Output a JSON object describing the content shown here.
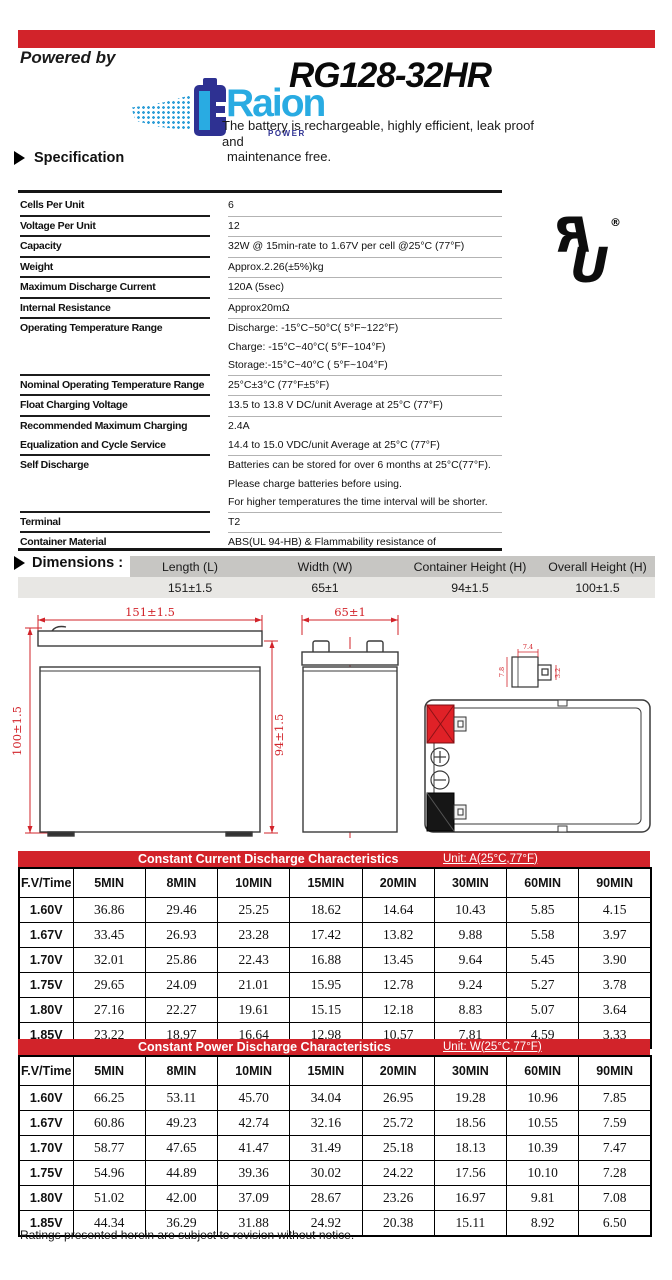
{
  "colors": {
    "accent_red": "#d2232a",
    "logo_blue": "#29abe2",
    "logo_dark_blue": "#2e3192",
    "dim_header_grey": "#c7c6c3",
    "dim_value_grey": "#e8e7e4"
  },
  "header": {
    "powered_by": "Powered by",
    "brand": "Raion",
    "brand_sub": "POWER",
    "model": "RG128-32HR",
    "description_line1": "The battery is rechargeable, highly efficient, leak proof and",
    "description_line2": "maintenance free.",
    "section_specification": "Specification"
  },
  "spec": {
    "rows": [
      {
        "label": [
          "Cells Per Unit"
        ],
        "value": [
          "6"
        ]
      },
      {
        "label": [
          "Voltage Per Unit"
        ],
        "value": [
          "12"
        ]
      },
      {
        "label": [
          "Capacity"
        ],
        "value": [
          "32W @ 15min-rate to 1.67V per cell @25°C (77°F)"
        ]
      },
      {
        "label": [
          "Weight"
        ],
        "value": [
          "Approx.2.26(±5%)kg"
        ]
      },
      {
        "label": [
          "Maximum Discharge Current"
        ],
        "value": [
          "120A (5sec)"
        ]
      },
      {
        "label": [
          "Internal Resistance"
        ],
        "value": [
          "Approx20mΩ"
        ]
      },
      {
        "label": [
          "Operating Temperature Range"
        ],
        "value": [
          "Discharge: -15°C~50°C( 5°F~122°F)",
          "Charge: -15°C~40°C( 5°F~104°F)",
          "Storage:-15°C~40°C ( 5°F~104°F)"
        ]
      },
      {
        "label": [
          "Nominal Operating Temperature Range"
        ],
        "value": [
          "25°C±3°C (77°F±5°F)"
        ]
      },
      {
        "label": [
          "Float Charging Voltage"
        ],
        "value": [
          "13.5 to 13.8 V DC/unit Average at 25°C (77°F)"
        ]
      },
      {
        "label": [
          "Recommended Maximum Charging",
          "Equalization and Cycle Service"
        ],
        "value": [
          "2.4A",
          "14.4 to 15.0 VDC/unit Average at 25°C (77°F)"
        ]
      },
      {
        "label": [
          "Self Discharge"
        ],
        "value": [
          "Batteries can be stored for over 6 months at 25°C(77°F).",
          "Please charge batteries before using.",
          "For higher temperatures the time interval will be shorter."
        ]
      },
      {
        "label": [
          "Terminal"
        ],
        "value": [
          "T2"
        ]
      },
      {
        "label": [
          "Container Material"
        ],
        "value": [
          "ABS(UL 94-HB) & Flammability resistance of",
          "(UL 94-V0) can be available upon request."
        ]
      }
    ]
  },
  "ul_mark": {
    "registered": "®"
  },
  "dimensions": {
    "title": "Dimensions :",
    "unit": "Unit: mm",
    "columns": [
      "Length (L)",
      "Width (W)",
      "Container Height (H)",
      "Overall Height (H)"
    ],
    "values": [
      "151±1.5",
      "65±1",
      "94±1.5",
      "100±1.5"
    ]
  },
  "drawing": {
    "front_width": "151±1.5",
    "front_height_overall": "100±1.5",
    "front_height_container": "94±1.5",
    "side_width": "65±1",
    "terminal_dim_top": "7.4",
    "terminal_dim_left": "7.8",
    "terminal_dim_right": "3.2"
  },
  "tables": [
    {
      "type": "table",
      "title": "Constant Current Discharge Characteristics",
      "unit": "Unit: A(25°C,77°F)",
      "col_header": [
        "F.V/Time",
        "5MIN",
        "8MIN",
        "10MIN",
        "15MIN",
        "20MIN",
        "30MIN",
        "60MIN",
        "90MIN"
      ],
      "rows": [
        [
          "1.60V",
          "36.86",
          "29.46",
          "25.25",
          "18.62",
          "14.64",
          "10.43",
          "5.85",
          "4.15"
        ],
        [
          "1.67V",
          "33.45",
          "26.93",
          "23.28",
          "17.42",
          "13.82",
          "9.88",
          "5.58",
          "3.97"
        ],
        [
          "1.70V",
          "32.01",
          "25.86",
          "22.43",
          "16.88",
          "13.45",
          "9.64",
          "5.45",
          "3.90"
        ],
        [
          "1.75V",
          "29.65",
          "24.09",
          "21.01",
          "15.95",
          "12.78",
          "9.24",
          "5.27",
          "3.78"
        ],
        [
          "1.80V",
          "27.16",
          "22.27",
          "19.61",
          "15.15",
          "12.18",
          "8.83",
          "5.07",
          "3.64"
        ],
        [
          "1.85V",
          "23.22",
          "18.97",
          "16.64",
          "12.98",
          "10.57",
          "7.81",
          "4.59",
          "3.33"
        ]
      ]
    },
    {
      "type": "table",
      "title": "Constant Power Discharge Characteristics",
      "unit": "Unit: W(25°C,77°F)",
      "col_header": [
        "F.V/Time",
        "5MIN",
        "8MIN",
        "10MIN",
        "15MIN",
        "20MIN",
        "30MIN",
        "60MIN",
        "90MIN"
      ],
      "rows": [
        [
          "1.60V",
          "66.25",
          "53.11",
          "45.70",
          "34.04",
          "26.95",
          "19.28",
          "10.96",
          "7.85"
        ],
        [
          "1.67V",
          "60.86",
          "49.23",
          "42.74",
          "32.16",
          "25.72",
          "18.56",
          "10.55",
          "7.59"
        ],
        [
          "1.70V",
          "58.77",
          "47.65",
          "41.47",
          "31.49",
          "25.18",
          "18.13",
          "10.39",
          "7.47"
        ],
        [
          "1.75V",
          "54.96",
          "44.89",
          "39.36",
          "30.02",
          "24.22",
          "17.56",
          "10.10",
          "7.28"
        ],
        [
          "1.80V",
          "51.02",
          "42.00",
          "37.09",
          "28.67",
          "23.26",
          "16.97",
          "9.81",
          "7.08"
        ],
        [
          "1.85V",
          "44.34",
          "36.29",
          "31.88",
          "24.92",
          "20.38",
          "15.11",
          "8.92",
          "6.50"
        ]
      ]
    }
  ],
  "footer_note": "Ratings presented herein are subject to revision without notice."
}
